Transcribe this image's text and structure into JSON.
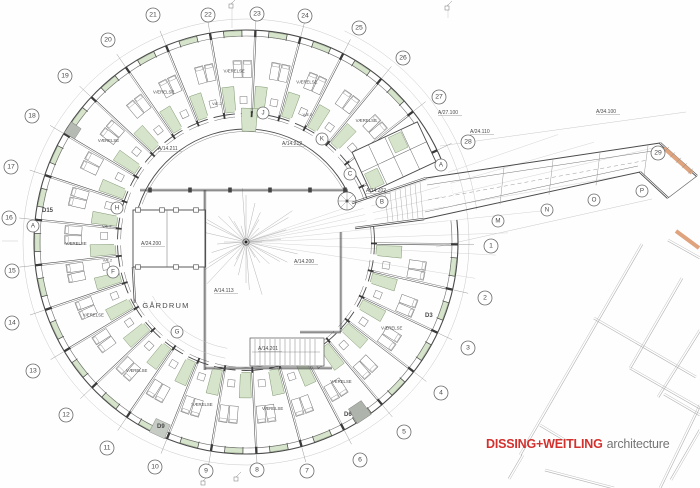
{
  "logo": {
    "brand": "DISSING+WEITLING",
    "suffix": "architecture"
  },
  "colors": {
    "wall": "#4a4a4a",
    "wall_light": "#6e6e6e",
    "thin": "#999999",
    "faint": "#c9c9c9",
    "green": "#d5e4ca",
    "green_line": "#7e9470",
    "orange": "#dfa37e",
    "gray_fill": "#aeb4ac",
    "red": "#d2312e",
    "text_gray": "#5a5a5a"
  },
  "plan": {
    "center": {
      "x": 246,
      "y": 242
    },
    "courtyard_label": "GÅRDRUM",
    "room_label": "VÆRELSE",
    "bath_label": "VÆ.2",
    "grid_numbers": [
      {
        "n": "1",
        "x": 491,
        "y": 246
      },
      {
        "n": "2",
        "x": 485,
        "y": 298
      },
      {
        "n": "3",
        "x": 468,
        "y": 348
      },
      {
        "n": "4",
        "x": 441,
        "y": 393
      },
      {
        "n": "5",
        "x": 404,
        "y": 432
      },
      {
        "n": "6",
        "x": 360,
        "y": 460
      },
      {
        "n": "7",
        "x": 307,
        "y": 471
      },
      {
        "n": "8",
        "x": 257,
        "y": 470
      },
      {
        "n": "9",
        "x": 206,
        "y": 471
      },
      {
        "n": "10",
        "x": 155,
        "y": 467
      },
      {
        "n": "11",
        "x": 107,
        "y": 448
      },
      {
        "n": "12",
        "x": 66,
        "y": 415
      },
      {
        "n": "13",
        "x": 33,
        "y": 371
      },
      {
        "n": "14",
        "x": 12,
        "y": 323
      },
      {
        "n": "15",
        "x": 12,
        "y": 271
      },
      {
        "n": "16",
        "x": 9,
        "y": 218
      },
      {
        "n": "17",
        "x": 11,
        "y": 167
      },
      {
        "n": "18",
        "x": 32,
        "y": 116
      },
      {
        "n": "19",
        "x": 65,
        "y": 76
      },
      {
        "n": "20",
        "x": 108,
        "y": 40
      },
      {
        "n": "21",
        "x": 153,
        "y": 15
      },
      {
        "n": "22",
        "x": 208,
        "y": 15
      },
      {
        "n": "23",
        "x": 257,
        "y": 14
      },
      {
        "n": "24",
        "x": 305,
        "y": 16
      },
      {
        "n": "25",
        "x": 359,
        "y": 28
      },
      {
        "n": "26",
        "x": 403,
        "y": 58
      },
      {
        "n": "27",
        "x": 439,
        "y": 97
      },
      {
        "n": "28",
        "x": 468,
        "y": 142
      },
      {
        "n": "29",
        "x": 658,
        "y": 153
      }
    ],
    "grid_letters": [
      {
        "n": "A",
        "x": 441,
        "y": 165
      },
      {
        "n": "A",
        "x": 33,
        "y": 226
      },
      {
        "n": "B",
        "x": 382,
        "y": 202
      },
      {
        "n": "C",
        "x": 350,
        "y": 174
      },
      {
        "n": "F",
        "x": 113,
        "y": 272
      },
      {
        "n": "G",
        "x": 177,
        "y": 332
      },
      {
        "n": "H",
        "x": 117,
        "y": 208
      },
      {
        "n": "J",
        "x": 263,
        "y": 113
      },
      {
        "n": "K",
        "x": 322,
        "y": 139
      },
      {
        "n": "M",
        "x": 498,
        "y": 221
      },
      {
        "n": "N",
        "x": 547,
        "y": 210
      },
      {
        "n": "O",
        "x": 594,
        "y": 200
      },
      {
        "n": "P",
        "x": 642,
        "y": 191
      }
    ],
    "ref_labels": [
      {
        "text": "A/14.211",
        "x": 158,
        "y": 150
      },
      {
        "text": "A/14.212",
        "x": 282,
        "y": 145
      },
      {
        "text": "A/14.202",
        "x": 366,
        "y": 192
      },
      {
        "text": "A/14.200",
        "x": 294,
        "y": 263
      },
      {
        "text": "A/14.113",
        "x": 214,
        "y": 292
      },
      {
        "text": "A/14.201",
        "x": 258,
        "y": 350
      },
      {
        "text": "A/24.200",
        "x": 141,
        "y": 245
      },
      {
        "text": "A/27.100",
        "x": 438,
        "y": 114
      },
      {
        "text": "A/24.110",
        "x": 470,
        "y": 133
      },
      {
        "text": "A/34.100",
        "x": 596,
        "y": 113
      }
    ],
    "door_labels": [
      {
        "text": "D15",
        "x": 42,
        "y": 212
      },
      {
        "text": "D9",
        "x": 157,
        "y": 428
      },
      {
        "text": "D6",
        "x": 344,
        "y": 416
      },
      {
        "text": "D3",
        "x": 425,
        "y": 317
      }
    ],
    "room_label_angles": [
      31,
      56,
      81,
      105,
      130,
      154,
      179,
      216,
      241,
      266,
      291,
      315
    ],
    "bath_label_angles": [
      172,
      186,
      258,
      296
    ]
  }
}
